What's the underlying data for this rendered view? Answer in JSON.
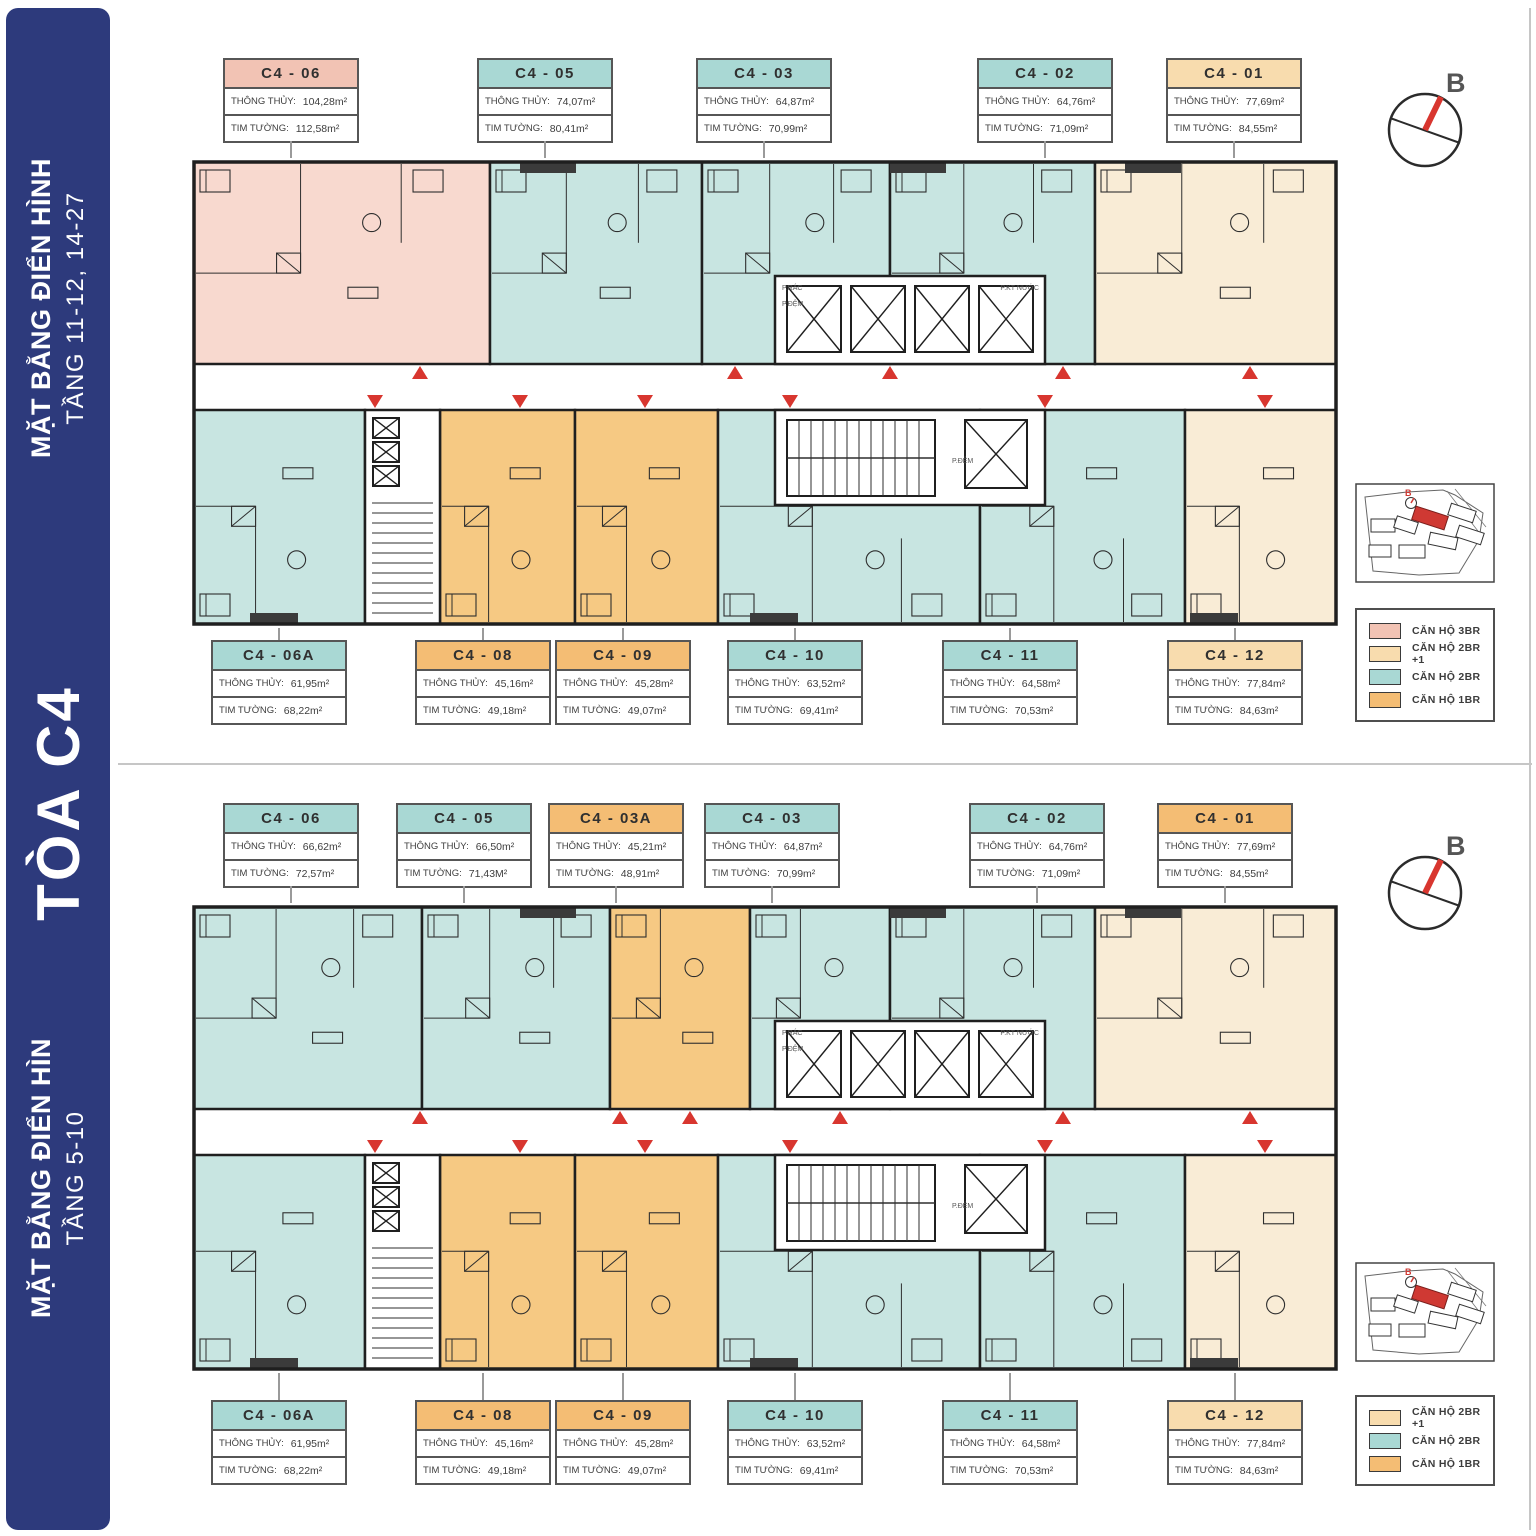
{
  "sidebar": {
    "top_title": "MẶT BẰNG ĐIỂN HÌNH",
    "top_subtitle": "TẦNG 11-12, 14-27",
    "tower": "TÒA C4",
    "bottom_title": "MẶT BẰNG ĐIỂN HÌN",
    "bottom_subtitle": "TẦNG 5-10"
  },
  "palette": {
    "navy": "#2d3a7c",
    "pink": "#f2c3b4",
    "pink_fill": "#f8d9cf",
    "teal": "#a9d8d4",
    "teal_fill": "#c8e5e1",
    "cream": "#f8dcae",
    "cream_fill": "#f9ecd6",
    "orange": "#f4bd74",
    "orange_fill": "#f6c983",
    "wall": "#1f1f1f",
    "red": "#d8362f",
    "leader_gray": "#9a9a9a"
  },
  "field_labels": {
    "net": "THÔNG THỦY:",
    "gross": "TIM TƯỜNG:"
  },
  "core_labels": {
    "trash": "P.RÁC",
    "buffer": "P.ĐỆM",
    "water": "P.KT NƯỚC"
  },
  "minimap": {
    "compass_letter": "B"
  },
  "plans": [
    {
      "name": "TẦNG 11-12, 14-27",
      "compass_letter": "B",
      "top_units": [
        {
          "id": "C4 - 06",
          "type": "3br",
          "net": "104,28m²",
          "gross": "112,58m²"
        },
        {
          "id": "C4 - 05",
          "type": "2br",
          "net": "74,07m²",
          "gross": "80,41m²"
        },
        {
          "id": "C4 - 03",
          "type": "2br",
          "net": "64,87m²",
          "gross": "70,99m²"
        },
        {
          "id": "C4 - 02",
          "type": "2br",
          "net": "64,76m²",
          "gross": "71,09m²"
        },
        {
          "id": "C4 - 01",
          "type": "2br1",
          "net": "77,69m²",
          "gross": "84,55m²"
        }
      ],
      "bottom_units": [
        {
          "id": "C4 - 06A",
          "type": "2br",
          "net": "61,95m²",
          "gross": "68,22m²"
        },
        {
          "id": "C4 - 08",
          "type": "1br",
          "net": "45,16m²",
          "gross": "49,18m²"
        },
        {
          "id": "C4 - 09",
          "type": "1br",
          "net": "45,28m²",
          "gross": "49,07m²"
        },
        {
          "id": "C4 - 10",
          "type": "2br",
          "net": "63,52m²",
          "gross": "69,41m²"
        },
        {
          "id": "C4 - 11",
          "type": "2br",
          "net": "64,58m²",
          "gross": "70,53m²"
        },
        {
          "id": "C4 - 12",
          "type": "2br1",
          "net": "77,84m²",
          "gross": "84,63m²"
        }
      ],
      "legend": [
        {
          "type": "3br",
          "label": "CĂN HỘ 3BR"
        },
        {
          "type": "2br1",
          "label": "CĂN HỘ 2BR +1"
        },
        {
          "type": "2br",
          "label": "CĂN HỘ 2BR"
        },
        {
          "type": "1br",
          "label": "CĂN HỘ 1BR"
        }
      ]
    },
    {
      "name": "TẦNG 5-10",
      "compass_letter": "B",
      "top_units": [
        {
          "id": "C4 - 06",
          "type": "2br",
          "net": "66,62m²",
          "gross": "72,57m²"
        },
        {
          "id": "C4 - 05",
          "type": "2br",
          "net": "66,50m²",
          "gross": "71,43M²"
        },
        {
          "id": "C4 - 03A",
          "type": "1br",
          "net": "45,21m²",
          "gross": "48,91m²"
        },
        {
          "id": "C4 - 03",
          "type": "2br",
          "net": "64,87m²",
          "gross": "70,99m²"
        },
        {
          "id": "C4 - 02",
          "type": "2br",
          "net": "64,76m²",
          "gross": "71,09m²"
        },
        {
          "id": "C4 - 01",
          "type": "1br",
          "fill": "2br1",
          "net": "77,69m²",
          "gross": "84,55m²"
        }
      ],
      "bottom_units": [
        {
          "id": "C4 - 06A",
          "type": "2br",
          "net": "61,95m²",
          "gross": "68,22m²"
        },
        {
          "id": "C4 - 08",
          "type": "1br",
          "net": "45,16m²",
          "gross": "49,18m²"
        },
        {
          "id": "C4 - 09",
          "type": "1br",
          "net": "45,28m²",
          "gross": "49,07m²"
        },
        {
          "id": "C4 - 10",
          "type": "2br",
          "net": "63,52m²",
          "gross": "69,41m²"
        },
        {
          "id": "C4 - 11",
          "type": "2br",
          "net": "64,58m²",
          "gross": "70,53m²"
        },
        {
          "id": "C4 - 12",
          "type": "2br1",
          "net": "77,84m²",
          "gross": "84,63m²"
        }
      ],
      "legend": [
        {
          "type": "2br1",
          "label": "CĂN HỘ 2BR +1"
        },
        {
          "type": "2br",
          "label": "CĂN HỘ 2BR"
        },
        {
          "type": "1br",
          "label": "CĂN HỘ 1BR"
        }
      ]
    }
  ]
}
